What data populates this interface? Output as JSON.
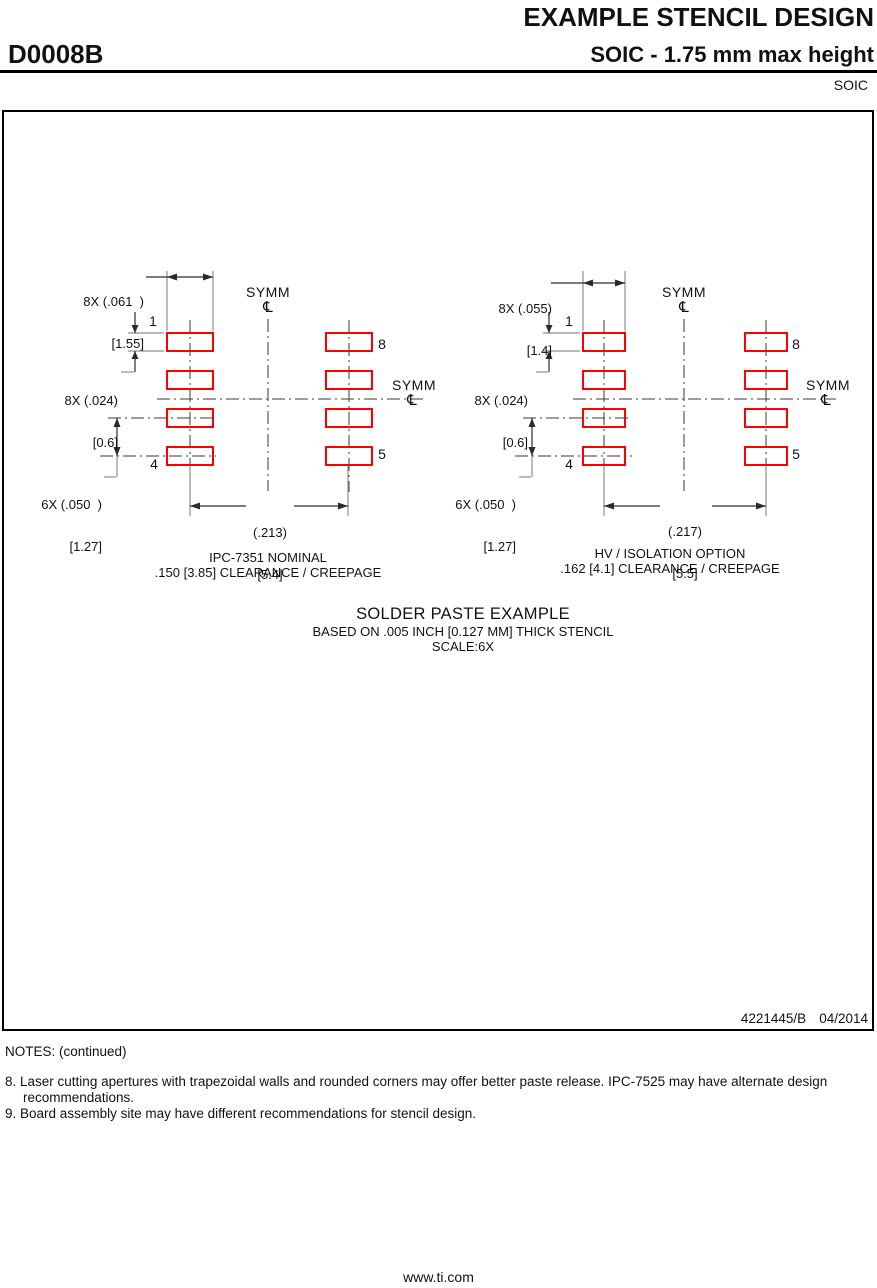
{
  "header": {
    "title": "EXAMPLE STENCIL DESIGN",
    "package_code": "D0008B",
    "package_desc": "SOIC - 1.75 mm max height",
    "package_family": "SOIC"
  },
  "symbols": {
    "centerline": "℄"
  },
  "colors": {
    "pad_red": "#FF0000",
    "line_black": "#2B2B2B",
    "line_gray": "#8F8F8F",
    "rule_black": "#000000"
  },
  "diagrams": {
    "left": {
      "pad_width_in": "8X (.061  )",
      "pad_width_mm": "[1.55]",
      "pad_height_in": "8X (.024)",
      "pad_height_mm": "[0.6]",
      "pitch_in": "6X (.050  )",
      "pitch_mm": "[1.27]",
      "span_in": "(.213)",
      "span_mm": "[5.4]",
      "pin_top_left": "1",
      "pin_top_right": "8",
      "pin_bottom_left": "4",
      "pin_bottom_right": "5",
      "symm": "SYMM",
      "caption_line1": "IPC-7351 NOMINAL",
      "caption_line2": ".150 [3.85] CLEARANCE / CREEPAGE"
    },
    "right": {
      "pad_width_in": "8X (.055)",
      "pad_width_mm": "[1.4]",
      "pad_height_in": "8X (.024)",
      "pad_height_mm": "[0.6]",
      "pitch_in": "6X (.050  )",
      "pitch_mm": "[1.27]",
      "span_in": "(.217)",
      "span_mm": "[5.5]",
      "pin_top_left": "1",
      "pin_top_right": "8",
      "pin_bottom_left": "4",
      "pin_bottom_right": "5",
      "symm": "SYMM",
      "caption_line1": "HV / ISOLATION OPTION",
      "caption_line2": ".162 [4.1] CLEARANCE / CREEPAGE"
    }
  },
  "solder_paste_note": {
    "line1": "SOLDER PASTE EXAMPLE",
    "line2": "BASED ON .005 INCH [0.127 MM] THICK STENCIL",
    "line3": "SCALE:6X"
  },
  "title_block": {
    "drawing_number": "4221445/B",
    "revision_date": "04/2014"
  },
  "notes": {
    "heading": "NOTES: (continued)",
    "items": [
      {
        "num": "8.",
        "text": "Laser cutting apertures with trapezoidal walls and rounded corners may offer better paste release. IPC-7525 may have alternate design recommendations."
      },
      {
        "num": "9.",
        "text": "Board assembly site may have different recommendations for stencil design."
      }
    ]
  },
  "page_footer": {
    "url": "www.ti.com"
  }
}
